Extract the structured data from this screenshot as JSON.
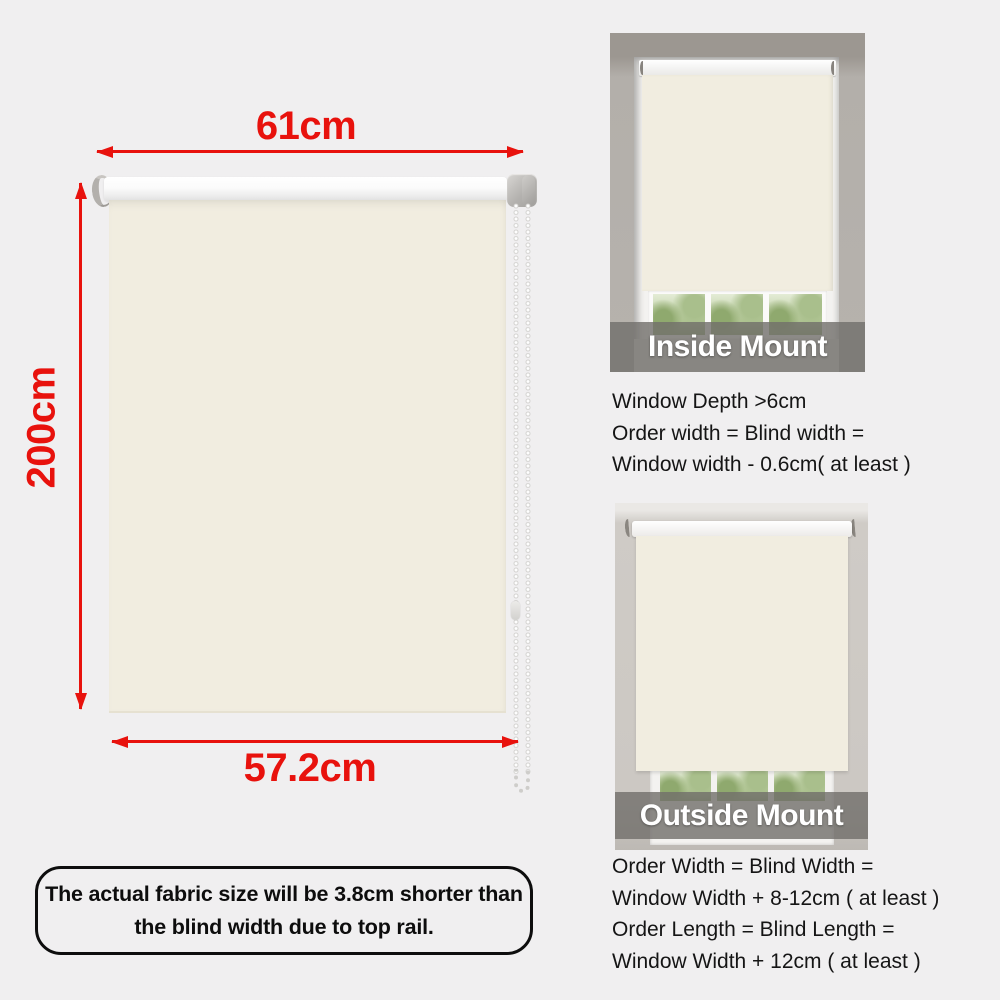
{
  "diagram": {
    "width_label": "61cm",
    "height_label": "200cm",
    "fabric_width_label": "57.2cm"
  },
  "note": {
    "line1": "The actual fabric size will be  3.8cm shorter than",
    "line2": "the blind width due to top rail."
  },
  "inside_mount": {
    "banner_label": "Inside Mount",
    "lines": [
      "Window Depth >6cm",
      "Order width = Blind width =",
      "Window width - 0.6cm( at least )"
    ]
  },
  "outside_mount": {
    "banner_label": "Outside Mount",
    "lines": [
      "Order Width = Blind Width =",
      "Window Width + 8-12cm ( at least )",
      "Order Length = Blind Length =",
      "Window Width + 12cm ( at least )"
    ]
  },
  "colors": {
    "dimension_red": "#e8120d",
    "fabric_cream": "#f1ede0",
    "background_gray": "#f0eff0",
    "banner_overlay": "rgba(113,110,106,0.80)",
    "banner_text": "#ffffff",
    "body_text": "#151515"
  }
}
